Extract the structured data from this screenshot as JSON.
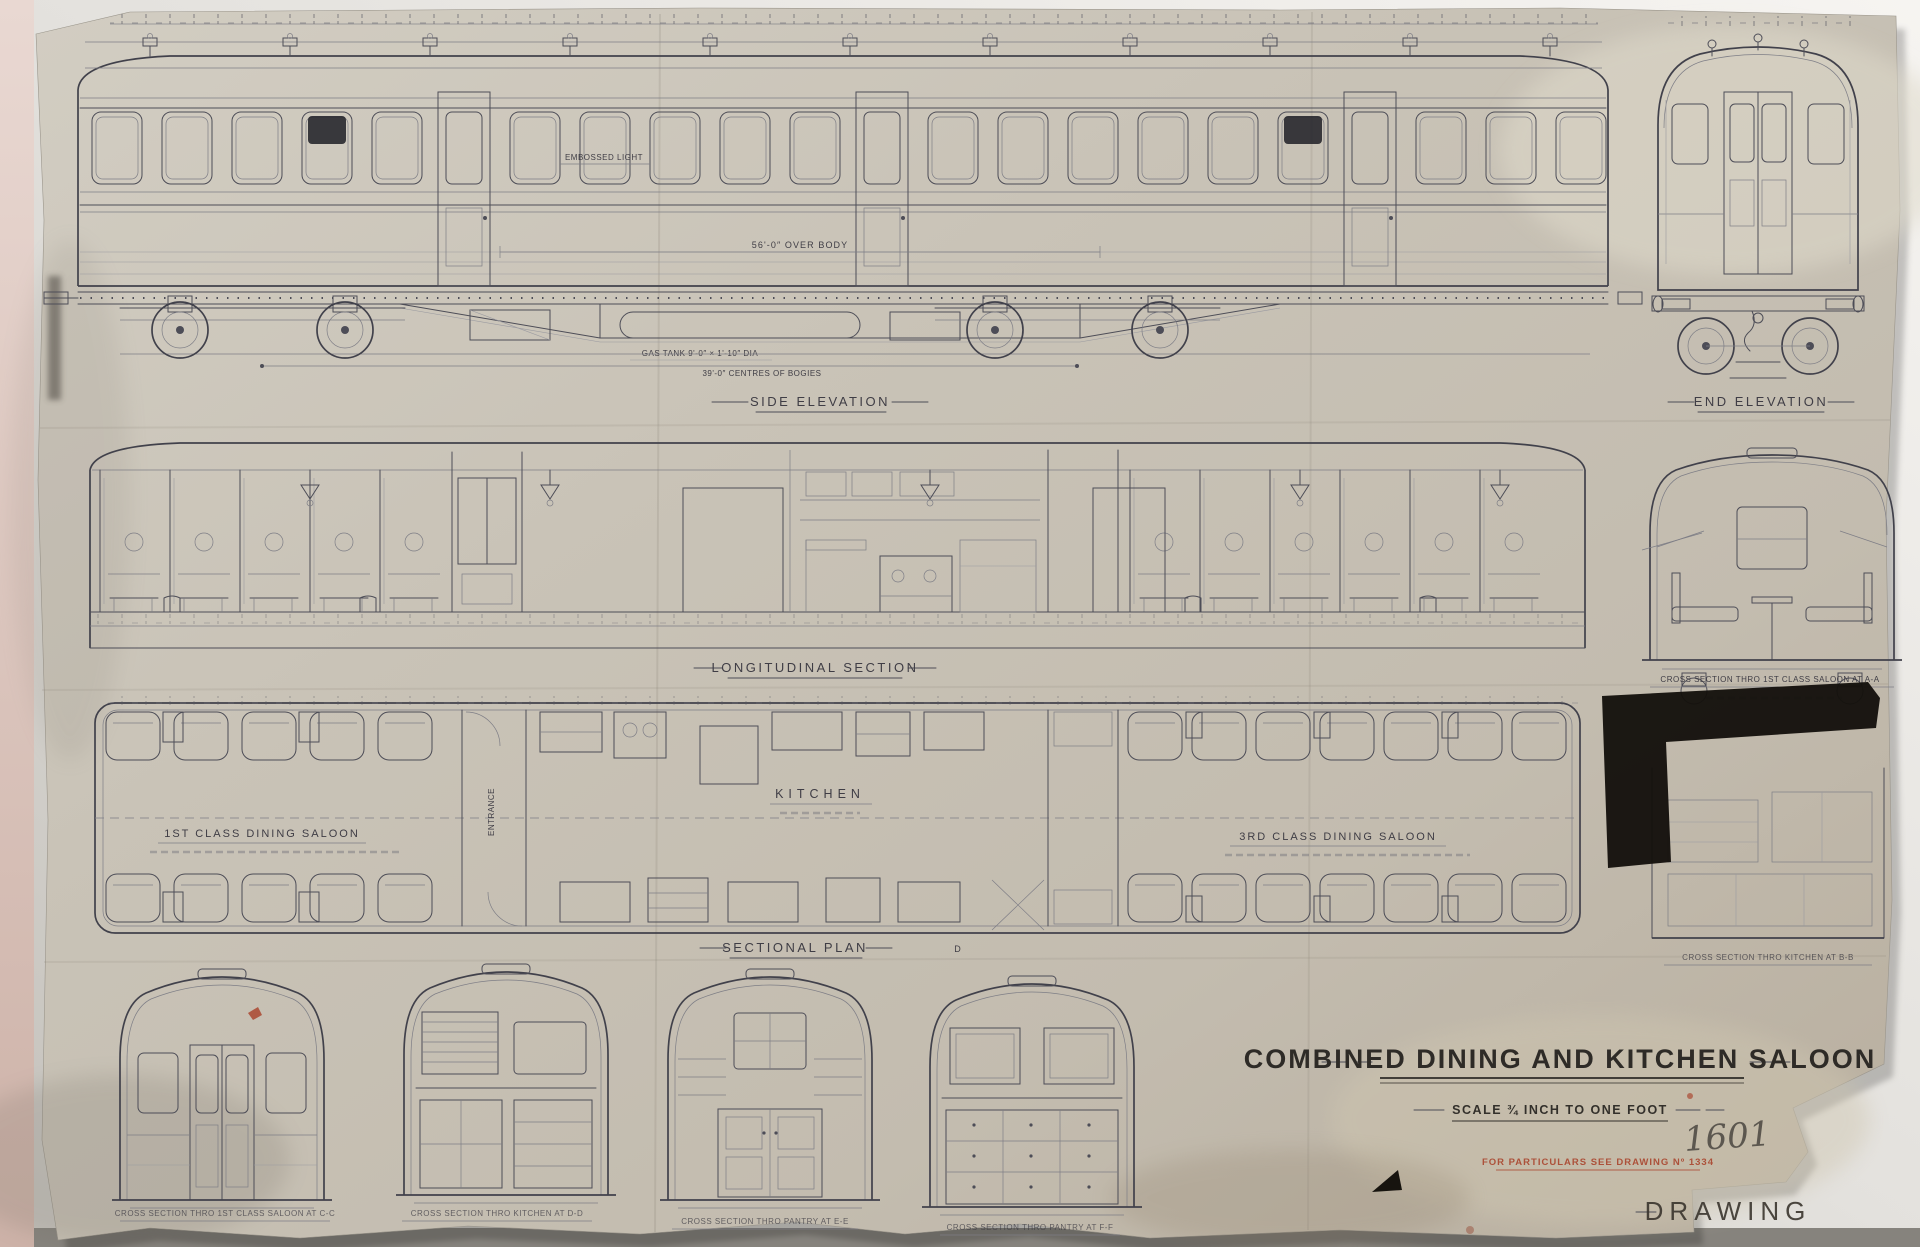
{
  "photo": {
    "colors": {
      "wall": "#f2f0ec",
      "paper": "#c9c3b7",
      "ink": "#4d4d57",
      "red_ink": "#a7371f",
      "censor_mark": "#14110d",
      "pink_edge": "#e5d0c8"
    }
  },
  "titles": {
    "main_title": "COMBINED DINING AND KITCHEN SALOON",
    "scale_note": "SCALE ¾ INCH TO ONE FOOT",
    "drawing_number": "1601",
    "red_reference_note": "FOR PARTICULARS SEE DRAWING Nº 1334",
    "stamp_text": "DRAWING"
  },
  "views": {
    "side_elevation": {
      "label": "SIDE ELEVATION",
      "embossed_light_note": "EMBOSSED LIGHT",
      "dim_over_body": "56'-0″ OVER BODY",
      "dim_bogie_centres": "39'-0″ CENTRES OF BOGIES",
      "gas_tank_note": "GAS TANK 9'-0″ × 1'-10″ DIA"
    },
    "end_elevation": {
      "label": "END ELEVATION"
    },
    "longitudinal_section": {
      "label": "LONGITUDINAL SECTION"
    },
    "sectional_plan": {
      "label": "SECTIONAL PLAN",
      "marker_d": "D",
      "room_first_class": "1ST CLASS DINING SALOON",
      "room_entrance": "ENTRANCE",
      "room_kitchen": "KITCHEN",
      "room_third_class": "3RD CLASS DINING SALOON"
    },
    "cross_sections": {
      "aa": {
        "label": "CROSS SECTION THRO 1ST CLASS SALOON AT A-A"
      },
      "bb": {
        "label": "CROSS SECTION THRO KITCHEN AT B-B"
      },
      "cc": {
        "label": "CROSS SECTION THRO 1ST CLASS SALOON AT C-C"
      },
      "dd": {
        "label": "CROSS SECTION THRO KITCHEN AT D-D"
      },
      "ee": {
        "label": "CROSS SECTION THRO PANTRY AT E-E"
      },
      "ff": {
        "label": "CROSS SECTION THRO PANTRY AT F-F"
      }
    }
  }
}
